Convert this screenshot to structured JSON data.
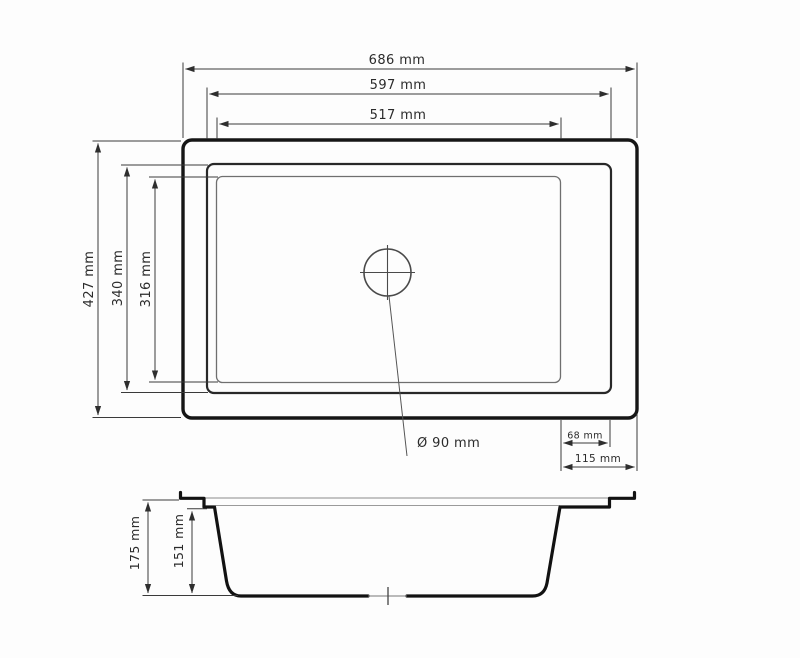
{
  "drawing": {
    "type": "technical-drawing",
    "subject": "kitchen sink dimensions, top view and side section view",
    "top_view": {
      "dims": {
        "outer_width": "686 mm",
        "rim_width": "597 mm",
        "bowl_width": "517 mm",
        "outer_height": "427 mm",
        "rim_height": "340 mm",
        "bowl_height": "316 mm",
        "right_ledge_inner": "68 mm",
        "right_ledge_outer": "115 mm",
        "drain_diameter": "Ø 90 mm"
      }
    },
    "side_view": {
      "dims": {
        "total_depth": "175 mm",
        "bowl_depth": "151 mm"
      }
    },
    "colors": {
      "outline_heavy": "#161616",
      "outline_medium": "#282828",
      "outline_light": "#6f6f6f",
      "dimension_lines": "#3a3a3a",
      "background": "#fdfdfd"
    }
  }
}
